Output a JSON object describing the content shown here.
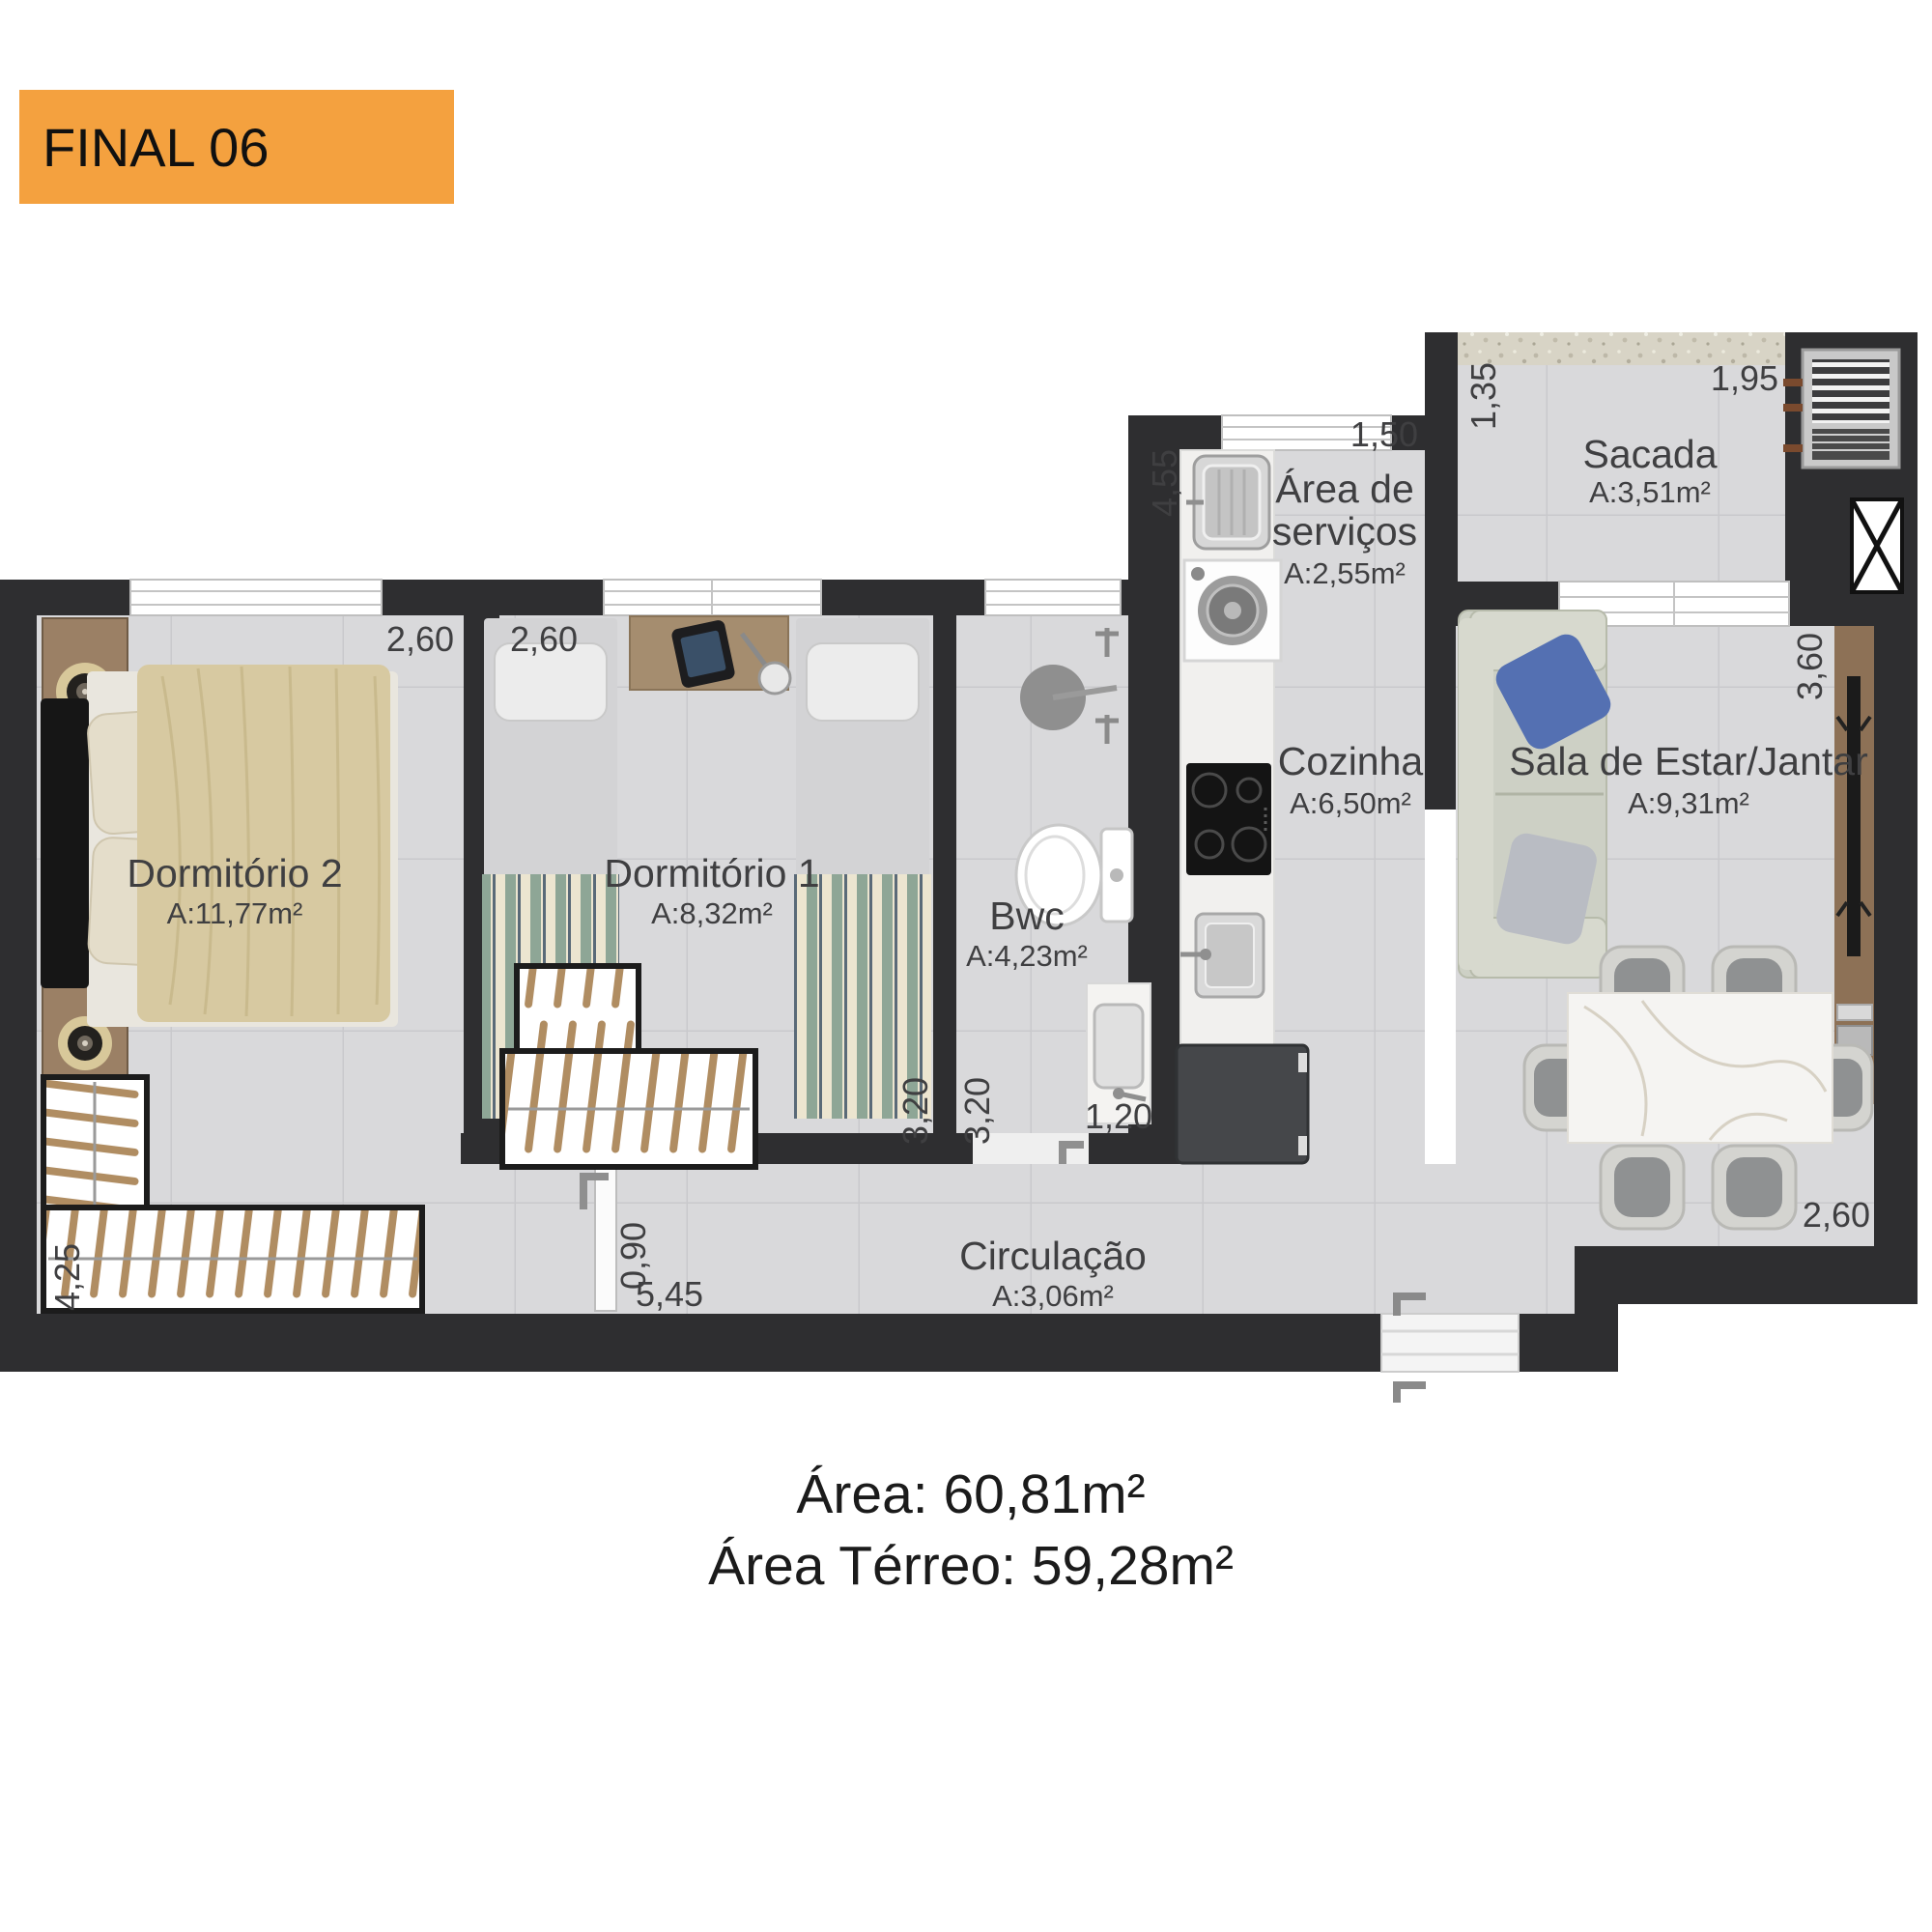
{
  "banner": {
    "label": "FINAL 06",
    "bg_color": "#F4A13F",
    "text_color": "#101010"
  },
  "footer": {
    "line1": "Área: 60,81m²",
    "line2": "Área Térreo: 59,28m²"
  },
  "rooms": [
    {
      "name": "Dormitório 2",
      "area": "A:11,77m²"
    },
    {
      "name": "Dormitório 1",
      "area": "A:8,32m²"
    },
    {
      "name": "Bwc",
      "area": "A:4,23m²"
    },
    {
      "name": "Cozinha",
      "area": "A:6,50m²"
    },
    {
      "name_line1": "Área de",
      "name_line2": "serviços",
      "area": "A:2,55m²"
    },
    {
      "name": "Sacada",
      "area": "A:3,51m²"
    },
    {
      "name": "Sala de Estar/Jantar",
      "area": "A:9,31m²"
    },
    {
      "name": "Circulação",
      "area": "A:3,06m²"
    }
  ],
  "dimensions": {
    "dorm2_width": "2,60",
    "dorm1_width": "2,60",
    "service_window": "1,50",
    "service_depth": "4,55",
    "sacada_depth": "1,35",
    "sacada_width": "1,95",
    "sala_depth": "3,60",
    "dorm1_depth": "3,20",
    "bwc_depth": "3,20",
    "kitchen_pass": "1,20",
    "bedroom_door": "0,90",
    "hall_length": "5,45",
    "dorm2_depth": "4,25",
    "sala_width": "2,60"
  },
  "colors": {
    "wall": "#2e2e30",
    "floor": "#d9d9db",
    "tile_line": "#c9c9cc",
    "banner_orange": "#F4A13F",
    "bed_duvet": "#d7c9a1",
    "blanket_green": "#8ea696",
    "sofa": "#cdd0c5",
    "cushion_blue": "#5470b2",
    "wood": "#9b8065"
  }
}
